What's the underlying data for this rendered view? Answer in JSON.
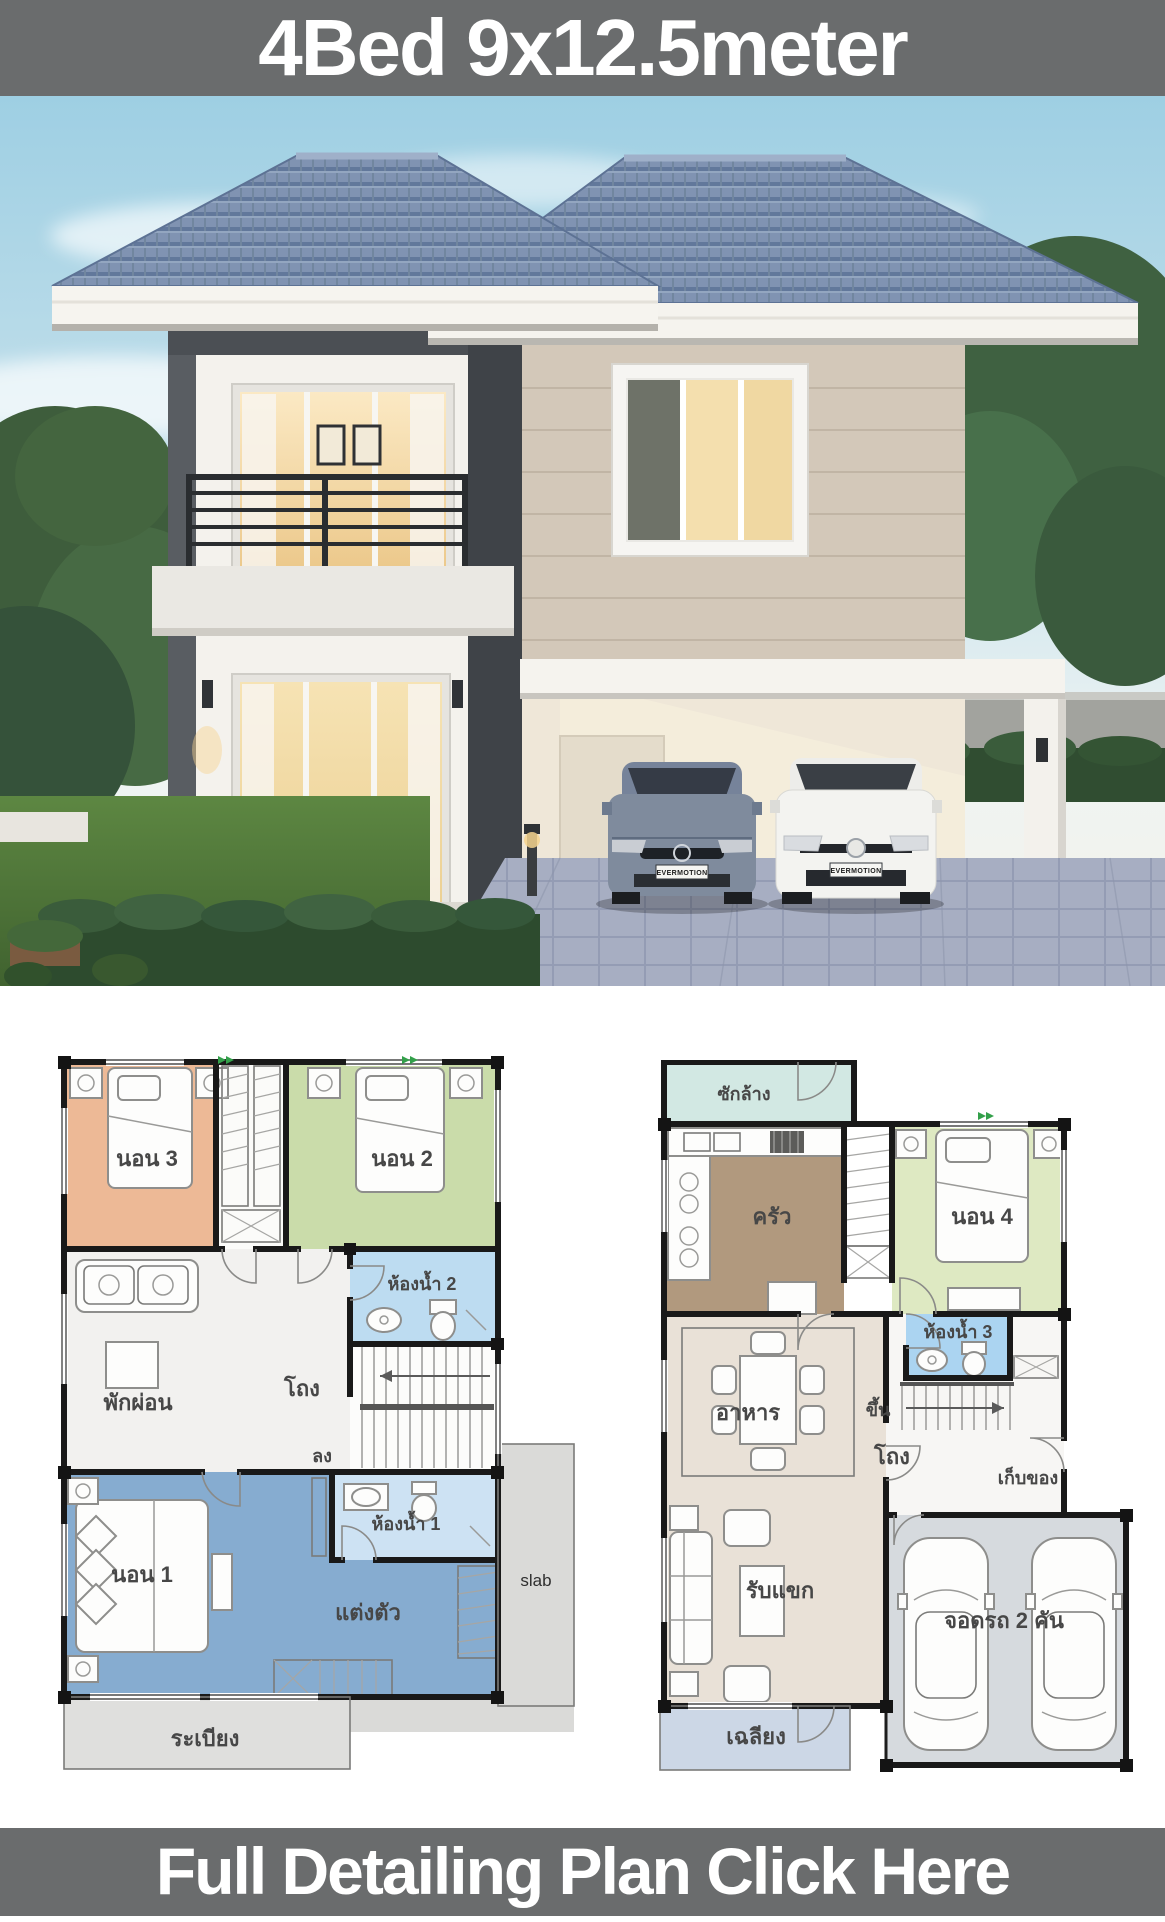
{
  "title": "4Bed 9x12.5meter",
  "cta": "Full Detailing Plan Click Here",
  "photo": {
    "license_plate_left": "EVERMOTION",
    "license_plate_right": "EVERMOTION"
  },
  "plans": {
    "second_floor": {
      "bedroom3": "นอน 3",
      "bedroom2": "นอน 2",
      "bathroom2": "ห้องน้ำ 2",
      "relax": "พักผ่อน",
      "hall": "โถง",
      "down": "ลง",
      "bedroom1": "นอน 1",
      "bathroom1": "ห้องน้ำ 1",
      "dressing": "แต่งตัว",
      "slab": "slab",
      "balcony": "ระเบียง"
    },
    "first_floor": {
      "laundry": "ซักล้าง",
      "kitchen": "ครัว",
      "bedroom4": "นอน 4",
      "bathroom3": "ห้องน้ำ 3",
      "dining": "อาหาร",
      "up": "ขึ้น",
      "hall": "โถง",
      "storage": "เก็บของ",
      "living": "รับแขก",
      "parking": "จอดรถ 2 คัน",
      "porch": "เฉลียง"
    }
  },
  "colors": {
    "banner_bg": "#6a6c6d",
    "roof": "#8093b2",
    "bedroom1": "#86acd0",
    "bedroom2": "#cadcaa",
    "bedroom3": "#edb996",
    "bedroom4": "#dee9c2",
    "bathroom1": "#cde2f3",
    "bathroom2": "#bddcf1",
    "bathroom3": "#abd4f1",
    "kitchen": "#b1997e",
    "laundry": "#d2e8e3",
    "dining_living": "#e9e1d7",
    "relax": "#f2f1ef",
    "garage": "#d6dade",
    "porch": "#ccd7e6",
    "balcony": "#dfdfdd",
    "slab": "#dadad8"
  }
}
